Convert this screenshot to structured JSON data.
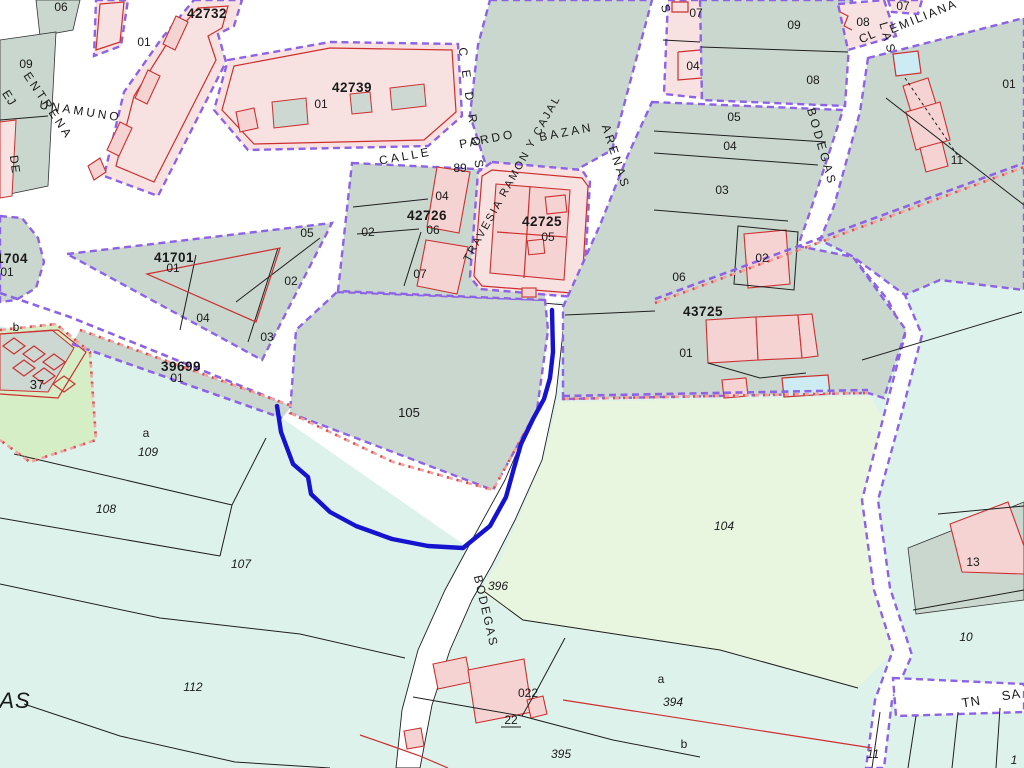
{
  "colors": {
    "manzana": "#c9d7ce",
    "rustic": "#def2ec",
    "green_light": "#e8f5df",
    "green_37": "#d6eec6",
    "pink_block": "#f8e2e1",
    "pink_building": "#f5d3d2",
    "building_grey": "#ccd8d1",
    "building_cyan": "#cdebf2",
    "red_outline": "#cd2f2f",
    "purple_boundary": "#8d62e5",
    "purple_label": "#7a55e2",
    "pink_dash": "#efa3a3",
    "red_dash_dot": "#d85050",
    "blue_path": "#1513cd",
    "black_line": "#1f1f1f",
    "red_text": "#d42222",
    "white": "#ffffff"
  },
  "map": {
    "labels": [
      {
        "t": "CALLE",
        "x": 406,
        "y": 160,
        "r": -10,
        "ls": 3,
        "cls": "street",
        "name": "street-label-calle"
      },
      {
        "t": "PARDO",
        "x": 488,
        "y": 143,
        "r": -11,
        "ls": 3,
        "cls": "street",
        "name": "street-label-pardo"
      },
      {
        "t": "BAZAN",
        "x": 567,
        "y": 136,
        "r": -11,
        "ls": 3,
        "cls": "street",
        "name": "street-label-bazan"
      },
      {
        "t": "TRAVESIA RAMON Y CAJAL",
        "x": 515,
        "y": 180,
        "r": -61,
        "s": 11,
        "ls": 2,
        "cls": "street",
        "name": "street-label-travesia-ramon-y-cajal"
      },
      {
        "t": "ARENAS",
        "x": 612,
        "y": 158,
        "r": 72,
        "ls": 3,
        "cls": "street",
        "name": "street-label-arenas"
      },
      {
        "t": "CEDROS",
        "x": 468,
        "y": 115,
        "r": 82,
        "ls": 14,
        "cls": "street",
        "name": "street-label-cedros"
      },
      {
        "t": "LAS",
        "x": 884,
        "y": 40,
        "r": 74,
        "ls": 4,
        "cls": "street",
        "name": "street-label-las"
      },
      {
        "t": "BODEGAS",
        "x": 818,
        "y": 148,
        "r": 74,
        "ls": 3,
        "cls": "street",
        "name": "street-label-bodegas"
      },
      {
        "t": "CL",
        "x": 869,
        "y": 40,
        "r": -24,
        "cls": "street",
        "name": "street-label-cl"
      },
      {
        "t": "EMILIANA",
        "x": 925,
        "y": 20,
        "r": -22,
        "ls": 2,
        "cls": "street",
        "name": "street-label-emiliana"
      },
      {
        "t": "S",
        "x": 662,
        "y": 10,
        "r": 74,
        "cls": "street",
        "name": "street-label-s-fragment"
      },
      {
        "t": "ENTRENA",
        "x": 45,
        "y": 108,
        "r": 56,
        "ls": 3,
        "cls": "street",
        "name": "street-label-entrena"
      },
      {
        "t": "UNAMUNO",
        "x": 80,
        "y": 115,
        "r": 9,
        "ls": 3,
        "cls": "street",
        "name": "street-label-unamuno"
      },
      {
        "t": "EJ",
        "x": 6,
        "y": 100,
        "r": 58,
        "cls": "street",
        "name": "street-label-ej-fragment"
      },
      {
        "t": "DE",
        "x": 11,
        "y": 165,
        "r": 82,
        "cls": "street redtxt",
        "name": "street-label-de"
      },
      {
        "t": "BODEGAS",
        "x": 482,
        "y": 612,
        "r": 77,
        "ls": 2,
        "cls": "street redtxt",
        "name": "street-label-bodegas-red"
      },
      {
        "t": "TN",
        "x": 972,
        "y": 706,
        "r": -9,
        "s": 13,
        "cls": "street",
        "name": "street-label-tn"
      },
      {
        "t": "SA",
        "x": 1012,
        "y": 699,
        "r": -9,
        "s": 13,
        "cls": "street",
        "name": "street-label-sa-fragment"
      },
      {
        "t": "AS",
        "x": 15,
        "y": 708,
        "s": 22,
        "cls": "street it",
        "name": "street-label-as-fragment"
      },
      {
        "t": "42732",
        "x": 207,
        "y": 18,
        "cls": "code",
        "name": "block-code-42732"
      },
      {
        "t": "42739",
        "x": 352,
        "y": 92,
        "cls": "code",
        "name": "block-code-42739"
      },
      {
        "t": "1704",
        "x": -4,
        "y": 263,
        "a": "start",
        "cls": "code",
        "name": "block-code-1704-clipped"
      },
      {
        "t": "41701",
        "x": 174,
        "y": 262,
        "cls": "code",
        "name": "block-code-41701"
      },
      {
        "t": "39699",
        "x": 181,
        "y": 371,
        "cls": "code",
        "name": "block-code-39699"
      },
      {
        "t": "42726",
        "x": 427,
        "y": 220,
        "cls": "code",
        "name": "block-code-42726"
      },
      {
        "t": "42725",
        "x": 542,
        "y": 226,
        "cls": "code",
        "name": "block-code-42725"
      },
      {
        "t": "43725",
        "x": 703,
        "y": 316,
        "cls": "code",
        "name": "block-code-43725"
      },
      {
        "t": "06",
        "x": 61,
        "y": 11
      },
      {
        "t": "09",
        "x": 26,
        "y": 68
      },
      {
        "t": "01",
        "x": 144,
        "y": 46
      },
      {
        "t": "01",
        "x": 321,
        "y": 108
      },
      {
        "t": "01",
        "x": 7,
        "y": 276
      },
      {
        "t": "01",
        "x": 173,
        "y": 272
      },
      {
        "t": "05",
        "x": 307,
        "y": 237
      },
      {
        "t": "02",
        "x": 291,
        "y": 285
      },
      {
        "t": "04",
        "x": 203,
        "y": 322
      },
      {
        "t": "03",
        "x": 267,
        "y": 341
      },
      {
        "t": "01",
        "x": 177,
        "y": 382
      },
      {
        "t": "37",
        "x": 37,
        "y": 389,
        "cls": "pnum big"
      },
      {
        "t": "89",
        "x": 460,
        "y": 172
      },
      {
        "t": "04",
        "x": 442,
        "y": 200
      },
      {
        "t": "02",
        "x": 368,
        "y": 236
      },
      {
        "t": "06",
        "x": 433,
        "y": 234
      },
      {
        "t": "07",
        "x": 420,
        "y": 278
      },
      {
        "t": "05",
        "x": 548,
        "y": 241
      },
      {
        "t": "07",
        "x": 696,
        "y": 17
      },
      {
        "t": "09",
        "x": 794,
        "y": 29
      },
      {
        "t": "04",
        "x": 693,
        "y": 70
      },
      {
        "t": "08",
        "x": 813,
        "y": 84
      },
      {
        "t": "05",
        "x": 734,
        "y": 121
      },
      {
        "t": "04",
        "x": 730,
        "y": 150
      },
      {
        "t": "03",
        "x": 722,
        "y": 194
      },
      {
        "t": "02",
        "x": 762,
        "y": 262
      },
      {
        "t": "06",
        "x": 679,
        "y": 281
      },
      {
        "t": "08",
        "x": 863,
        "y": 26
      },
      {
        "t": "07",
        "x": 903,
        "y": 10
      },
      {
        "t": "01",
        "x": 1009,
        "y": 88
      },
      {
        "t": "11",
        "x": 957,
        "y": 164
      },
      {
        "t": "01",
        "x": 686,
        "y": 357
      },
      {
        "t": "105",
        "x": 409,
        "y": 417,
        "cls": "pnum big",
        "name": "parcel-label-105"
      },
      {
        "t": "104",
        "x": 724,
        "y": 530,
        "cls": "pnum it",
        "name": "parcel-label-104"
      },
      {
        "t": "109",
        "x": 148,
        "y": 456,
        "cls": "pnum it"
      },
      {
        "t": "108",
        "x": 106,
        "y": 513,
        "cls": "pnum it"
      },
      {
        "t": "107",
        "x": 241,
        "y": 568,
        "cls": "pnum it"
      },
      {
        "t": "112",
        "x": 193,
        "y": 691,
        "cls": "pnum it"
      },
      {
        "t": "396",
        "x": 498,
        "y": 590,
        "cls": "pnum it"
      },
      {
        "t": "395",
        "x": 561,
        "y": 758,
        "cls": "pnum it"
      },
      {
        "t": "394",
        "x": 673,
        "y": 706,
        "cls": "pnum it"
      },
      {
        "t": "022",
        "x": 528,
        "y": 697
      },
      {
        "t": "22",
        "x": 511,
        "y": 724
      },
      {
        "t": "10",
        "x": 966,
        "y": 641,
        "cls": "pnum it"
      },
      {
        "t": "13",
        "x": 973,
        "y": 566
      },
      {
        "t": "11",
        "x": 873,
        "y": 758,
        "cls": "pnum it"
      },
      {
        "t": "1",
        "x": 1014,
        "y": 764,
        "cls": "pnum it"
      },
      {
        "t": "b",
        "x": 16,
        "y": 331,
        "cls": "pnum redtxt"
      },
      {
        "t": "a",
        "x": 146,
        "y": 437,
        "cls": "pnum redtxt"
      },
      {
        "t": "a",
        "x": 661,
        "y": 683,
        "cls": "pnum redtxt"
      },
      {
        "t": "b",
        "x": 684,
        "y": 748,
        "cls": "pnum redtxt"
      }
    ]
  }
}
